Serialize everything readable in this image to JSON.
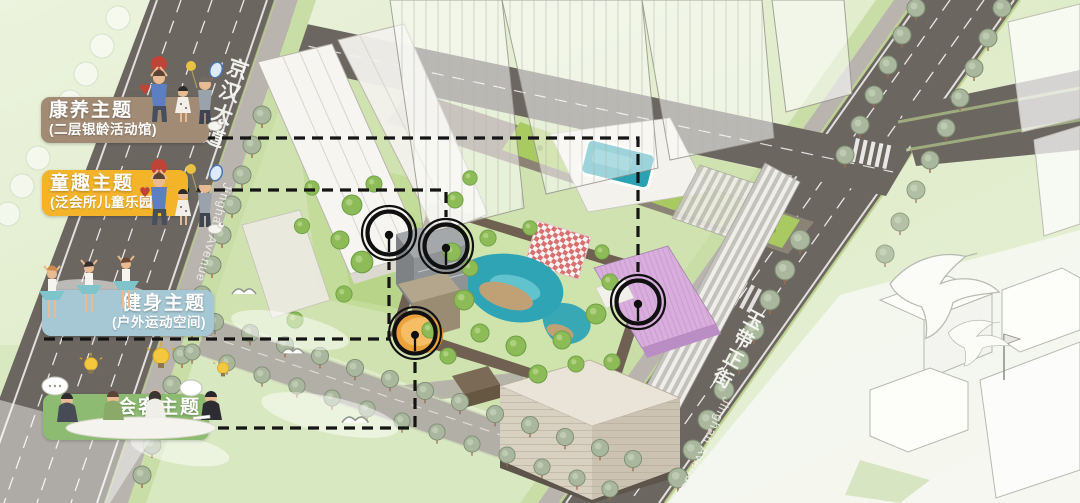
{
  "legend": [
    {
      "title": "康养主题",
      "subtitle": "(二层银龄活动馆)",
      "color": "#a28b74"
    },
    {
      "title": "童趣主题",
      "subtitle": "(泛会所儿童乐园)",
      "color": "#f3b42a"
    },
    {
      "title": "健身主题",
      "subtitle": "(户外运动空间)",
      "color": "#a6c8d4"
    },
    {
      "title": "会客主题",
      "subtitle": "(泛会所专属空间)",
      "color": "#8dbb71"
    }
  ],
  "streets": {
    "jinghan": {
      "cn": "京汉大道",
      "en": "Jinghan Avenue"
    },
    "yudai": {
      "cn": "玉带正街",
      "en": "Jinghan Avenue"
    }
  },
  "markers": [
    {
      "id": "fitness-courtyard-pin"
    },
    {
      "id": "clubhouse-children-pin"
    },
    {
      "id": "guest-space-pin"
    },
    {
      "id": "wellness-roof-pin"
    }
  ],
  "palette": {
    "road": "#6c6660",
    "minor_road": "#b2afa7",
    "site_green": "#cfe2b0",
    "roof_garden": "#a8ca60",
    "pool_teal": "#2aa2b4",
    "pond_teal": "#2fa4b5",
    "purple_building": "#d9aedd",
    "orange_playground": "#eba23d",
    "leader_line": "#151515"
  }
}
